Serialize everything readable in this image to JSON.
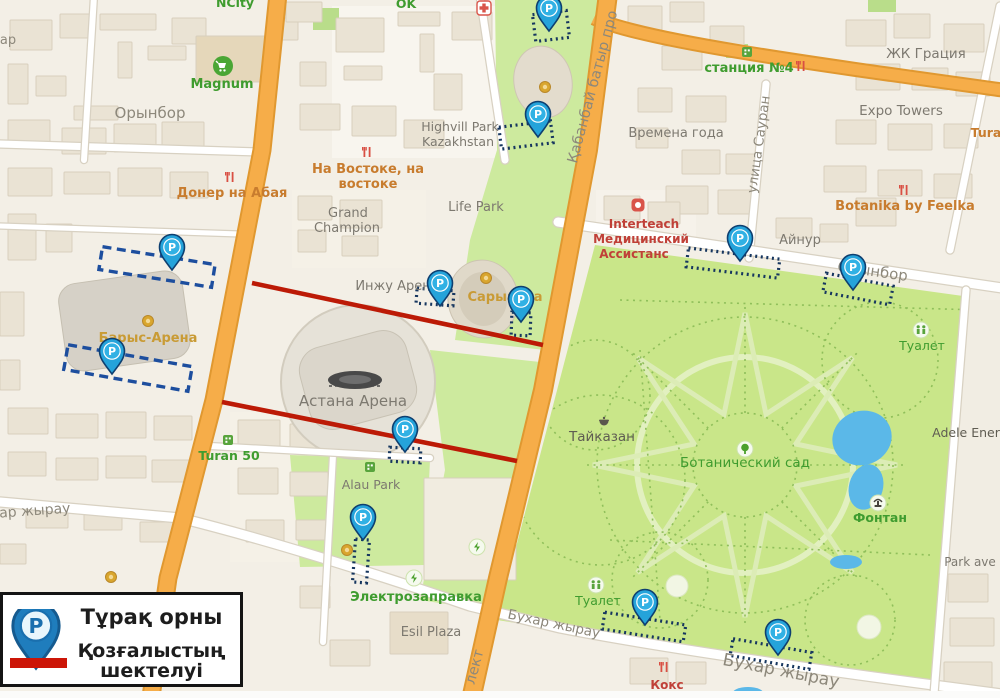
{
  "legend": {
    "parking_label": "Тұрақ орны",
    "restriction_label_line1": "Қозғалыстың",
    "restriction_label_line2": "шектелуі"
  },
  "colors": {
    "pin_blue": "#1f86c6",
    "pin_cyan": "#2aa9dd",
    "zone_blue": "#1d4e9e",
    "zone_dot_blue": "#16365f",
    "restriction_red": "#bc1a06",
    "road_orange": "#f6ad49",
    "park_green": "#c9e689",
    "water_blue": "#5bb8e8"
  },
  "map": {
    "labels": [
      {
        "t": "Орынбор",
        "x": 150,
        "y": 118,
        "s": 15,
        "c": "street"
      },
      {
        "t": "Орынбор",
        "x": 872,
        "y": 276,
        "s": 15,
        "c": "street",
        "r": 8
      },
      {
        "t": "Бухар жырау",
        "x": 22,
        "y": 516,
        "s": 14,
        "c": "street",
        "r": -4
      },
      {
        "t": "Бухар жырау",
        "x": 553,
        "y": 628,
        "s": 13.5,
        "c": "street",
        "r": 12
      },
      {
        "t": "Бухар жырау",
        "x": 780,
        "y": 676,
        "s": 17,
        "c": "street",
        "r": 11
      },
      {
        "t": "улица Сауран",
        "x": 763,
        "y": 145,
        "s": 13.5,
        "c": "street",
        "r": -82
      },
      {
        "t": "Қабанбай батыр про",
        "x": 597,
        "y": 88,
        "s": 14.5,
        "c": "street",
        "r": -75
      },
      {
        "t": "лект",
        "x": 479,
        "y": 668,
        "s": 14.5,
        "c": "street",
        "r": -75
      },
      {
        "t": "ар",
        "x": 8,
        "y": 44,
        "s": 13,
        "c": "street"
      },
      {
        "t": "Grand",
        "x": 348,
        "y": 217,
        "s": 13,
        "c": "poi"
      },
      {
        "t": "Champion",
        "x": 347,
        "y": 232,
        "s": 13,
        "c": "poi"
      },
      {
        "t": "Highvill Park",
        "x": 460,
        "y": 131,
        "s": 12.5,
        "c": "poi"
      },
      {
        "t": "Kazakhstan",
        "x": 458,
        "y": 146,
        "s": 12.5,
        "c": "poi"
      },
      {
        "t": "Life Park",
        "x": 476,
        "y": 211,
        "s": 13,
        "c": "poi"
      },
      {
        "t": "Инжу Арена",
        "x": 397,
        "y": 290,
        "s": 13,
        "c": "poi"
      },
      {
        "t": "Астана Арена",
        "x": 353,
        "y": 406,
        "s": 15,
        "c": "poi"
      },
      {
        "t": "Alau Park",
        "x": 371,
        "y": 489,
        "s": 12.5,
        "c": "poi"
      },
      {
        "t": "Esil Plaza",
        "x": 431,
        "y": 636,
        "s": 13,
        "c": "poi"
      },
      {
        "t": "Времена года",
        "x": 676,
        "y": 137,
        "s": 13,
        "c": "poi"
      },
      {
        "t": "ЖК Грация",
        "x": 926,
        "y": 58,
        "s": 13.5,
        "c": "poi"
      },
      {
        "t": "Expo Towers",
        "x": 901,
        "y": 115,
        "s": 13.5,
        "c": "poi"
      },
      {
        "t": "Айнур",
        "x": 800,
        "y": 244,
        "s": 13,
        "c": "poi"
      },
      {
        "t": "Park ave",
        "x": 970,
        "y": 566,
        "s": 12,
        "c": "poi"
      },
      {
        "t": "Adele Ener",
        "x": 966,
        "y": 437,
        "s": 12.5,
        "c": "dark"
      },
      {
        "t": "Тайказан",
        "x": 602,
        "y": 441,
        "s": 13.5,
        "c": "dark"
      },
      {
        "t": "Magnum",
        "x": 222,
        "y": 88,
        "s": 13,
        "c": "greenbold"
      },
      {
        "t": "NCity",
        "x": 235,
        "y": 7,
        "s": 12.5,
        "c": "greenbold"
      },
      {
        "t": "OK",
        "x": 406,
        "y": 8,
        "s": 12.5,
        "c": "greenbold"
      },
      {
        "t": "Turan 50",
        "x": 229,
        "y": 460,
        "s": 12.5,
        "c": "greenbold"
      },
      {
        "t": "Электрозаправка",
        "x": 416,
        "y": 601,
        "s": 13,
        "c": "greenbold"
      },
      {
        "t": "Туалет",
        "x": 922,
        "y": 350,
        "s": 12.5,
        "c": "green"
      },
      {
        "t": "Туалет",
        "x": 598,
        "y": 605,
        "s": 12.5,
        "c": "green"
      },
      {
        "t": "Ботанический сад",
        "x": 745,
        "y": 467,
        "s": 13.5,
        "c": "green"
      },
      {
        "t": "Фонтан",
        "x": 880,
        "y": 522,
        "s": 12.5,
        "c": "greenbold"
      },
      {
        "t": "станция №4",
        "x": 749,
        "y": 72,
        "s": 13,
        "c": "greenbold"
      },
      {
        "t": "Донер на Абая",
        "x": 232,
        "y": 197,
        "s": 13,
        "c": "orange"
      },
      {
        "t": "На Востоке, на",
        "x": 368,
        "y": 173,
        "s": 13,
        "c": "orange"
      },
      {
        "t": "востоке",
        "x": 368,
        "y": 188,
        "s": 13,
        "c": "orange"
      },
      {
        "t": "Botanika by Feelka",
        "x": 905,
        "y": 210,
        "s": 13,
        "c": "orange"
      },
      {
        "t": "Tura",
        "x": 986,
        "y": 137,
        "s": 12.5,
        "c": "orange"
      },
      {
        "t": "Сарыарқа",
        "x": 505,
        "y": 301,
        "s": 13,
        "c": "gold"
      },
      {
        "t": "Барыс-Арена",
        "x": 148,
        "y": 342,
        "s": 13,
        "c": "gold"
      },
      {
        "t": "Interteach",
        "x": 644,
        "y": 228,
        "s": 12,
        "c": "red"
      },
      {
        "t": "Медицинский",
        "x": 641,
        "y": 243,
        "s": 12,
        "c": "red"
      },
      {
        "t": "Ассистанс",
        "x": 634,
        "y": 258,
        "s": 12,
        "c": "red"
      },
      {
        "t": "Кокс",
        "x": 667,
        "y": 689,
        "s": 12,
        "c": "red"
      }
    ],
    "pins": [
      {
        "x": 549,
        "y": 12
      },
      {
        "x": 538,
        "y": 118
      },
      {
        "x": 440,
        "y": 287
      },
      {
        "x": 521,
        "y": 303
      },
      {
        "x": 740,
        "y": 242
      },
      {
        "x": 853,
        "y": 271
      },
      {
        "x": 405,
        "y": 433
      },
      {
        "x": 363,
        "y": 521
      },
      {
        "x": 645,
        "y": 606
      },
      {
        "x": 778,
        "y": 636
      },
      {
        "x": 172,
        "y": 251
      },
      {
        "x": 112,
        "y": 355
      }
    ],
    "parking_zones": [
      {
        "cx": 157,
        "cy": 267,
        "w": 114,
        "h": 23,
        "r": 9,
        "style": "dash"
      },
      {
        "cx": 128,
        "cy": 368,
        "w": 126,
        "h": 25,
        "r": 10,
        "style": "dash"
      },
      {
        "cx": 551,
        "cy": 26,
        "w": 34,
        "h": 27,
        "r": -7,
        "style": "dot"
      },
      {
        "cx": 526,
        "cy": 135,
        "w": 52,
        "h": 22,
        "r": -7,
        "style": "dot"
      },
      {
        "cx": 435,
        "cy": 297,
        "w": 37,
        "h": 15,
        "r": 4,
        "style": "dot"
      },
      {
        "cx": 521,
        "cy": 324,
        "w": 19,
        "h": 23,
        "r": 2,
        "style": "dot"
      },
      {
        "cx": 733,
        "cy": 263,
        "w": 92,
        "h": 19,
        "r": 7,
        "style": "dot"
      },
      {
        "cx": 858,
        "cy": 289,
        "w": 68,
        "h": 19,
        "r": 11,
        "style": "dot"
      },
      {
        "cx": 405,
        "cy": 455,
        "w": 31,
        "h": 14,
        "r": 3,
        "style": "dot"
      },
      {
        "cx": 361,
        "cy": 561,
        "w": 14,
        "h": 43,
        "r": 4,
        "style": "dot"
      },
      {
        "cx": 644,
        "cy": 627,
        "w": 82,
        "h": 17,
        "r": 9,
        "style": "dot"
      },
      {
        "cx": 771,
        "cy": 654,
        "w": 80,
        "h": 17,
        "r": 10,
        "style": "dot"
      }
    ],
    "restriction_lines": [
      {
        "x1": 252,
        "y1": 283,
        "x2": 543,
        "y2": 345
      },
      {
        "x1": 222,
        "y1": 402,
        "x2": 517,
        "y2": 461
      }
    ],
    "icons": [
      {
        "type": "restaurant",
        "x": 230,
        "y": 177
      },
      {
        "type": "restaurant",
        "x": 367,
        "y": 152
      },
      {
        "type": "restaurant",
        "x": 801,
        "y": 66
      },
      {
        "type": "restaurant",
        "x": 904,
        "y": 190
      },
      {
        "type": "restaurant",
        "x": 664,
        "y": 667
      },
      {
        "type": "wc",
        "x": 921,
        "y": 330
      },
      {
        "type": "wc",
        "x": 596,
        "y": 585
      },
      {
        "type": "tree",
        "x": 745,
        "y": 449
      },
      {
        "type": "fountain",
        "x": 878,
        "y": 503
      },
      {
        "type": "kazan",
        "x": 604,
        "y": 422
      },
      {
        "type": "medal",
        "x": 545,
        "y": 87
      },
      {
        "type": "medal",
        "x": 486,
        "y": 278
      },
      {
        "type": "medal",
        "x": 148,
        "y": 321
      },
      {
        "type": "medal",
        "x": 347,
        "y": 550
      },
      {
        "type": "medal",
        "x": 111,
        "y": 577
      },
      {
        "type": "ev",
        "x": 414,
        "y": 578
      },
      {
        "type": "ev",
        "x": 477,
        "y": 547
      },
      {
        "type": "building",
        "x": 228,
        "y": 440
      },
      {
        "type": "building",
        "x": 370,
        "y": 467
      },
      {
        "type": "building",
        "x": 747,
        "y": 52
      },
      {
        "type": "magnum",
        "x": 223,
        "y": 66
      },
      {
        "type": "medcross",
        "x": 484,
        "y": 8
      },
      {
        "type": "medpin",
        "x": 638,
        "y": 205
      },
      {
        "type": "stadium",
        "x": 355,
        "y": 380
      }
    ]
  }
}
